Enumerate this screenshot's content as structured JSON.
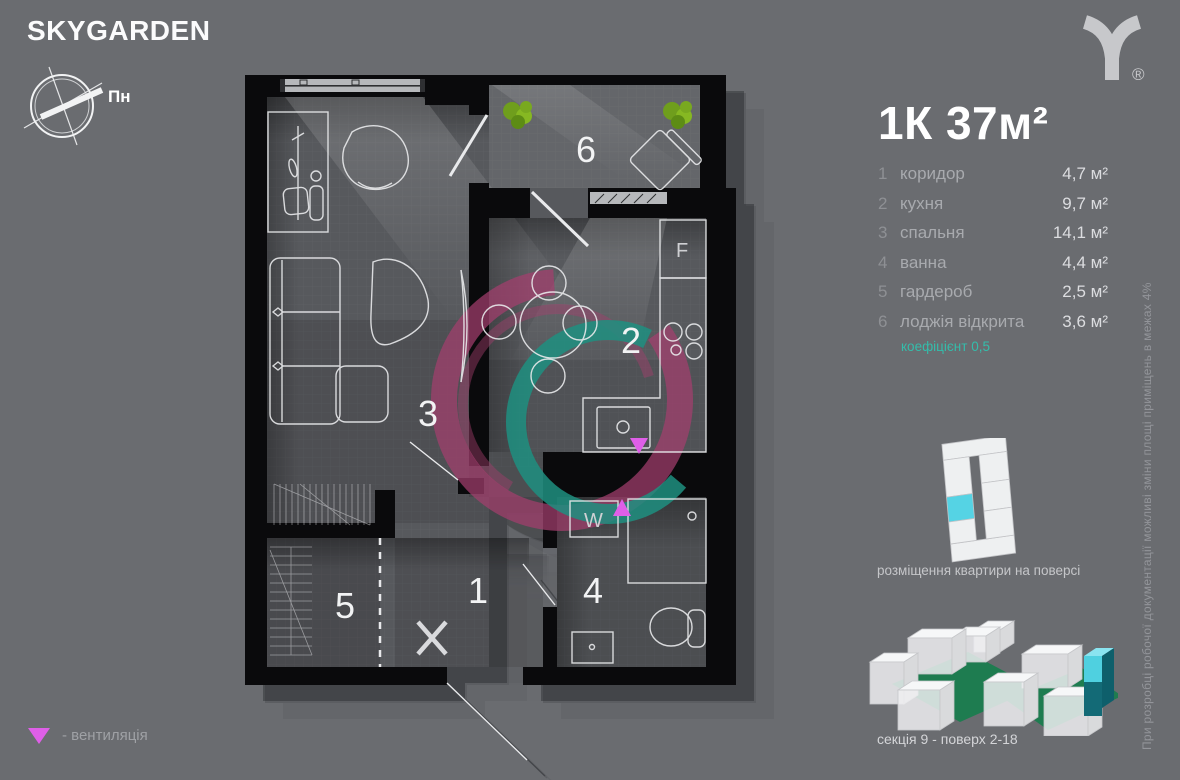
{
  "brand": {
    "logo_text": "SKYGARDEN",
    "trademark": "®"
  },
  "compass": {
    "north_label": "Пн"
  },
  "apartment": {
    "title": "1К 37м²",
    "rooms": [
      {
        "num": "1",
        "name": "коридор",
        "area": "4,7 м²"
      },
      {
        "num": "2",
        "name": "кухня",
        "area": "9,7 м²"
      },
      {
        "num": "3",
        "name": "спальня",
        "area": "14,1 м²"
      },
      {
        "num": "4",
        "name": "ванна",
        "area": "4,4 м²"
      },
      {
        "num": "5",
        "name": "гардероб",
        "area": "2,5 м²"
      },
      {
        "num": "6",
        "name": "лоджія відкрита",
        "area": "3,6 м²"
      }
    ],
    "coefficient_note": "коефіцієнт 0,5"
  },
  "plan": {
    "room_labels": {
      "r1": "1",
      "r2": "2",
      "r3": "3",
      "r4": "4",
      "r5": "5",
      "r6": "6"
    },
    "appliance_labels": {
      "fridge": "F",
      "washer": "W"
    }
  },
  "placement": {
    "caption": "розміщення квартири на поверсі"
  },
  "building": {
    "caption": "секція 9 - поверх 2-18"
  },
  "legend": {
    "ventilation": "- вентиляція"
  },
  "disclaimer": "При розробці робочої документації можливі зміни площі приміщень в межах 4%",
  "colors": {
    "background": "#6a6c70",
    "wall_black": "#0a0a0c",
    "accent_teal": "#34bdab",
    "vent_magenta": "#df5fe8",
    "highlight_cyan": "#55d3e4",
    "courtyard_green": "#1e7c50",
    "swirl_magenta": "#a33e6d",
    "swirl_teal": "#1f8f80"
  }
}
